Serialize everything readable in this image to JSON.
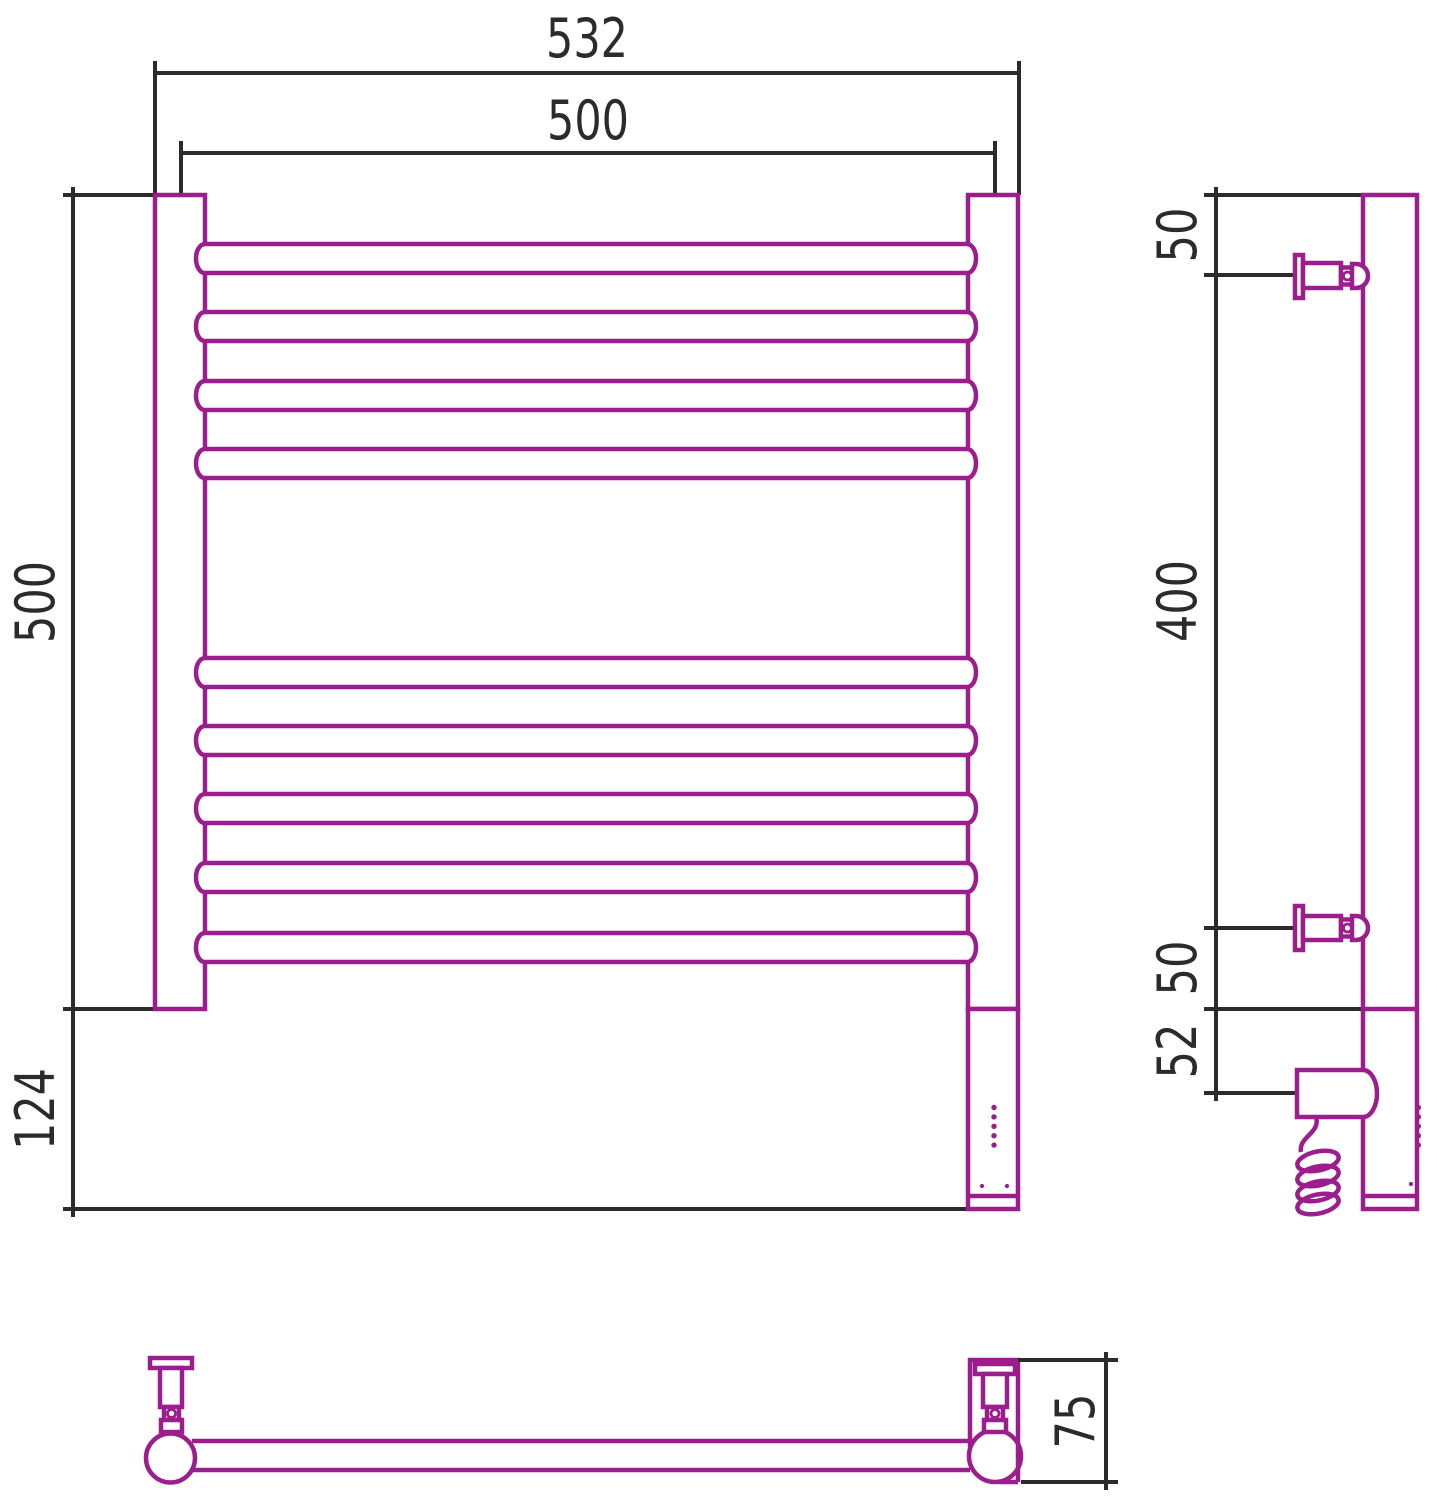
{
  "drawing": {
    "title": "heated-towel-rail-dimension-drawing",
    "views": {
      "front": {
        "dims": {
          "overall_width": "532",
          "mount_centers_width": "500",
          "rail_section_height": "500",
          "lower_section_height": "124"
        },
        "rails": {
          "count": 9,
          "tops_y": [
            244,
            312,
            381,
            449,
            658,
            726,
            794,
            863,
            933
          ],
          "height": 29
        },
        "indicator_leds": {
          "count": 5
        },
        "bottom_dots": {
          "count": 2
        }
      },
      "side": {
        "dims": {
          "top_bracket_offset": "50",
          "bracket_span": "400",
          "bottom_bracket_offset": "50",
          "housing_depth": "52"
        }
      },
      "top": {
        "dims": {
          "depth": "75"
        }
      }
    },
    "colors": {
      "outline": "#9B1E8C",
      "dimension": "#2D2A2B",
      "background": "#FFFFFF"
    }
  }
}
